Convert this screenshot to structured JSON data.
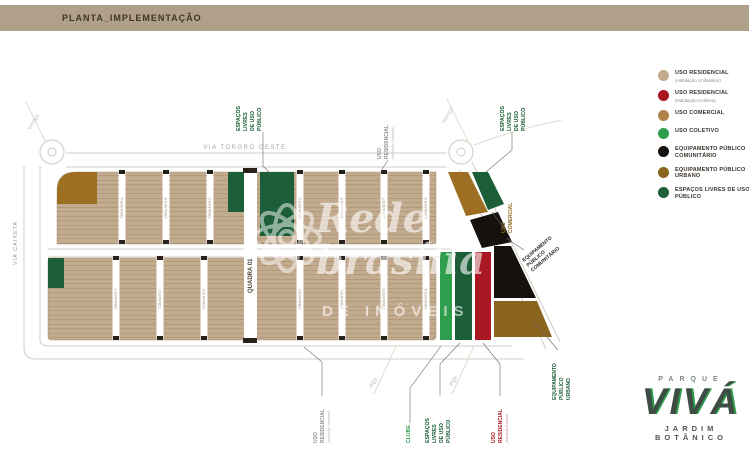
{
  "header": {
    "title": "PLANTA_IMPLEMENTAÇÃO"
  },
  "colors": {
    "residencial_unifamiliar": "#c3ab8f",
    "residencial_coletiva": "#a81722",
    "comercial": "#9c6f22",
    "coletivo": "#2f9e4c",
    "equip_comunitario": "#17110d",
    "equip_urbano": "#8a641f",
    "espacos_livres": "#1b5e38"
  },
  "map": {
    "roads": {
      "via_tororo": "VIA TORORÓ OESTE",
      "via_caixeta": "VIA CAIXETA",
      "quadra": "QUADRA 01",
      "via_pq1": "VIA PQ1",
      "via_pq2": "VIA PQ2",
      "pq3": "PQ3",
      "pq4": "PQ4"
    },
    "row1_strips": [
      "CONJUNTO A",
      "CONJUNTO B",
      "CONJUNTO C",
      "CONJUNTO D",
      "CONJUNTO E",
      "CONJUNTO F",
      "CONJUNTO G"
    ],
    "row2_strips": [
      "CONJUNTO H",
      "CONJUNTO I",
      "CONJUNTO J",
      "CONJUNTO K",
      "CONJUNTO L",
      "CONJUNTO M",
      "CONJUNTO N"
    ]
  },
  "annotations": {
    "espacos_top_left": {
      "lines": [
        "ESPAÇOS",
        "LIVRES",
        "DE USO",
        "PÚBLICO"
      ]
    },
    "uso_residencial_top": {
      "lines": [
        "USO",
        "RESIDENCIAL"
      ],
      "sub": "(Habitação Unifamiliar)"
    },
    "espacos_top_right": {
      "lines": [
        "ESPAÇOS",
        "LIVRES",
        "DE USO",
        "PÚBLICO"
      ]
    },
    "uso_comercial": {
      "lines": [
        "USO",
        "COMERCIAL"
      ]
    },
    "equip_comunitario": {
      "lines": [
        "EQUIPAMENTO",
        "PÚBLICO",
        "COMUNITÁRIO"
      ]
    },
    "uso_residencial_bottom": {
      "lines": [
        "USO",
        "RESIDENCIAL"
      ],
      "sub": "(Habitação Unifamiliar)"
    },
    "clube": {
      "lines": [
        "CLUBE"
      ]
    },
    "espacos_bottom": {
      "lines": [
        "ESPAÇOS",
        "LIVRES",
        "DE USO",
        "PÚBLICO"
      ]
    },
    "uso_residencial_coletiva": {
      "lines": [
        "USO",
        "RESIDENCIAL"
      ],
      "sub": "(Habitação Coletiva)"
    },
    "equip_urbano": {
      "lines": [
        "EQUIPAMENTO",
        "PÚBLICO",
        "URBANO"
      ]
    }
  },
  "legend": {
    "items": [
      {
        "color": "#c3ab8f",
        "label": "USO RESIDENCIAL",
        "sublabel": "(Habitação Unifamiliar)"
      },
      {
        "color": "#a81722",
        "label": "USO RESIDENCIAL",
        "sublabel": "(Habitação Coletiva)"
      },
      {
        "color": "#b0824a",
        "label": "USO COMERCIAL",
        "sublabel": ""
      },
      {
        "color": "#2f9e4c",
        "label": "USO COLETIVO",
        "sublabel": ""
      },
      {
        "color": "#17110d",
        "label": "EQUIPAMENTO PÚBLICO COMUNITÁRIO",
        "sublabel": ""
      },
      {
        "color": "#8a641f",
        "label": "EQUIPAMENTO PÚBLICO URBANO",
        "sublabel": ""
      },
      {
        "color": "#1b5e38",
        "label": "ESPAÇOS LIVRES DE USO PÚBLICO",
        "sublabel": ""
      }
    ]
  },
  "watermark": {
    "line1": "Rede",
    "line2": "brasília",
    "line3": "DE IMÓVEIS"
  },
  "logo": {
    "top": "PARQUE",
    "main": "VIVÁ",
    "bottom": "JARDIM BOTÂNICO"
  }
}
